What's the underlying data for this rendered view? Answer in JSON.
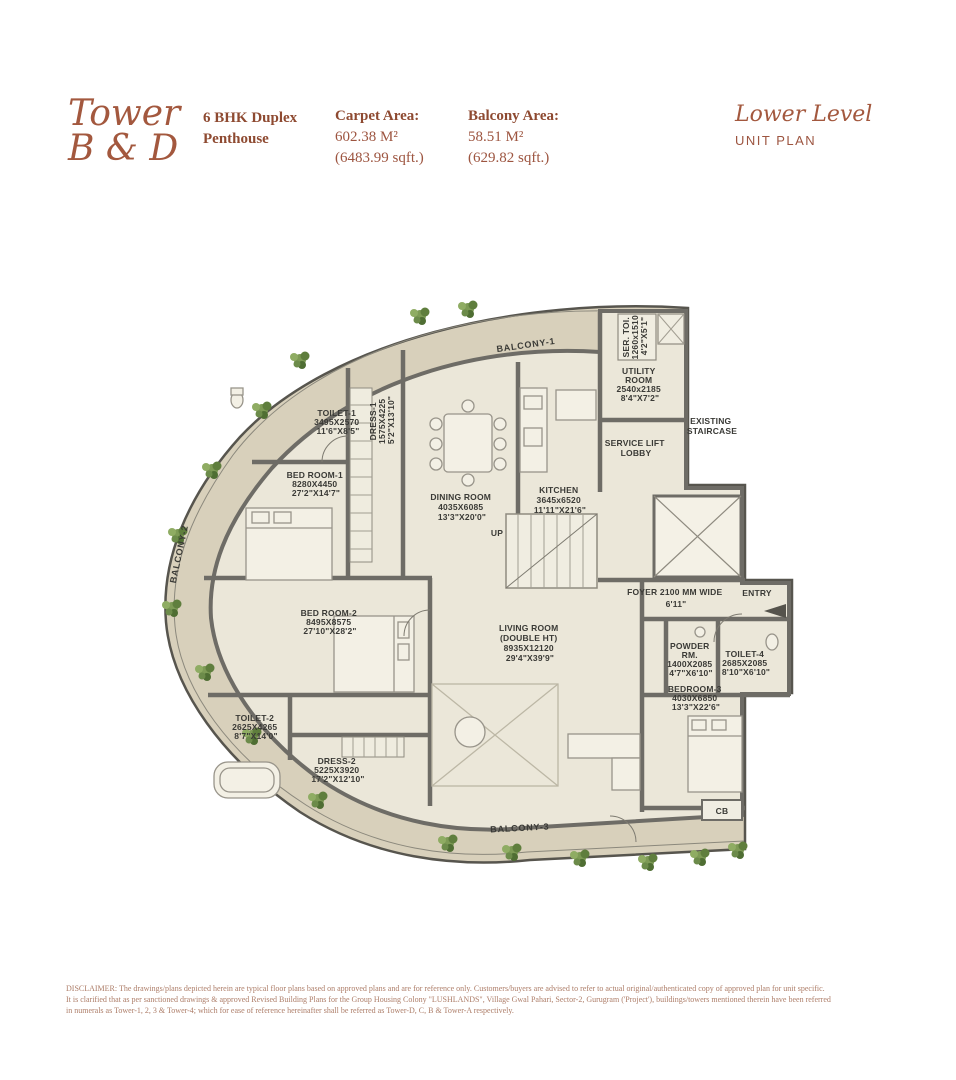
{
  "header": {
    "tower": {
      "line1": "Tower",
      "line2": "B & D"
    },
    "unit_type": {
      "line1": "6 BHK Duplex",
      "line2": "Penthouse"
    },
    "carpet": {
      "label": "Carpet Area:",
      "m2": "602.38 M²",
      "sqft": "(6483.99 sqft.)"
    },
    "balcony": {
      "label": "Balcony Area:",
      "m2": "58.51 M²",
      "sqft": "(629.82 sqft.)"
    },
    "level": {
      "title": "Lower Level",
      "subtitle": "UNIT PLAN"
    }
  },
  "plan": {
    "rooms": {
      "balcony1": {
        "lines": [
          "BALCONY-1"
        ]
      },
      "ser_toi": {
        "lines": [
          "SER. TOI.",
          "1260x1510",
          "4'2\"X5'1\""
        ]
      },
      "utility": {
        "lines": [
          "UTILITY",
          "ROOM",
          "2540x2185",
          "8'4\"X7'2\""
        ]
      },
      "service_lift_lobby": {
        "lines": [
          "SERVICE LIFT",
          "LOBBY"
        ]
      },
      "existing_staircase": {
        "lines": [
          "EXISTING",
          "STAIRCASE"
        ]
      },
      "toilet1": {
        "lines": [
          "TOILET-1",
          "3495X2570",
          "11'6\"X8'5\""
        ]
      },
      "dress1": {
        "lines": [
          "DRESS-1",
          "1575X4225",
          "5'2\"X13'10\""
        ]
      },
      "bedroom1": {
        "lines": [
          "BED ROOM-1",
          "8280X4450",
          "27'2\"X14'7\""
        ]
      },
      "dining": {
        "lines": [
          "DINING ROOM",
          "4035X6085",
          "13'3\"X20'0\""
        ]
      },
      "kitchen": {
        "lines": [
          "KITCHEN",
          "3645x6520",
          "11'11\"X21'6\""
        ]
      },
      "up": {
        "lines": [
          "UP"
        ]
      },
      "balcony2": {
        "lines": [
          "BALCONY-2"
        ]
      },
      "bedroom2": {
        "lines": [
          "BED ROOM-2",
          "8495X8575",
          "27'10\"X28'2\""
        ]
      },
      "foyer": {
        "lines": [
          "FOYER 2100 MM WIDE",
          "6'11\""
        ]
      },
      "entry": {
        "lines": [
          "ENTRY"
        ]
      },
      "living": {
        "lines": [
          "LIVING ROOM",
          "(DOUBLE HT)",
          "8935X12120",
          "29'4\"X39'9\""
        ]
      },
      "powder": {
        "lines": [
          "POWDER",
          "RM.",
          "1400X2085",
          "4'7\"X6'10\""
        ]
      },
      "toilet4": {
        "lines": [
          "TOILET-4",
          "2685X2085",
          "8'10\"X6'10\""
        ]
      },
      "bedroom3": {
        "lines": [
          "BEDROOM-3",
          "4030X6850",
          "13'3\"X22'6\""
        ]
      },
      "toilet2": {
        "lines": [
          "TOILET-2",
          "2625X4265",
          "8'7\"X14'0\""
        ]
      },
      "dress2": {
        "lines": [
          "DRESS-2",
          "5225X3920",
          "17'2\"X12'10\""
        ]
      },
      "balcony3": {
        "lines": [
          "BALCONY-3"
        ]
      },
      "cb": {
        "lines": [
          "CB"
        ]
      }
    }
  },
  "disclaimer": {
    "line1": "DISCLAIMER: The drawings/plans depicted herein are typical floor plans based on approved plans and are for reference only. Customers/buyers are advised to refer to actual original/authenticated copy of approved plan for unit specific.",
    "line2": "It is clarified that as per sanctioned drawings & approved Revised Building Plans for the Group Housing Colony \"LUSHLANDS\", Village Gwal Pahari, Sector-2, Gurugram ('Project'), buildings/towers mentioned therein have been referred",
    "line3": "in numerals as Tower-1, 2, 3 & Tower-4; which for ease of reference hereinafter shall be referred as Tower-D, C, B & Tower-A respectively."
  },
  "colors": {
    "accent_terracotta": "#a3583e",
    "wall_gray": "#6e6c66",
    "balcony_floor": "#d8d0bb",
    "interior_floor": "#ebe7d9",
    "plant_green": "#6c8b4a"
  }
}
